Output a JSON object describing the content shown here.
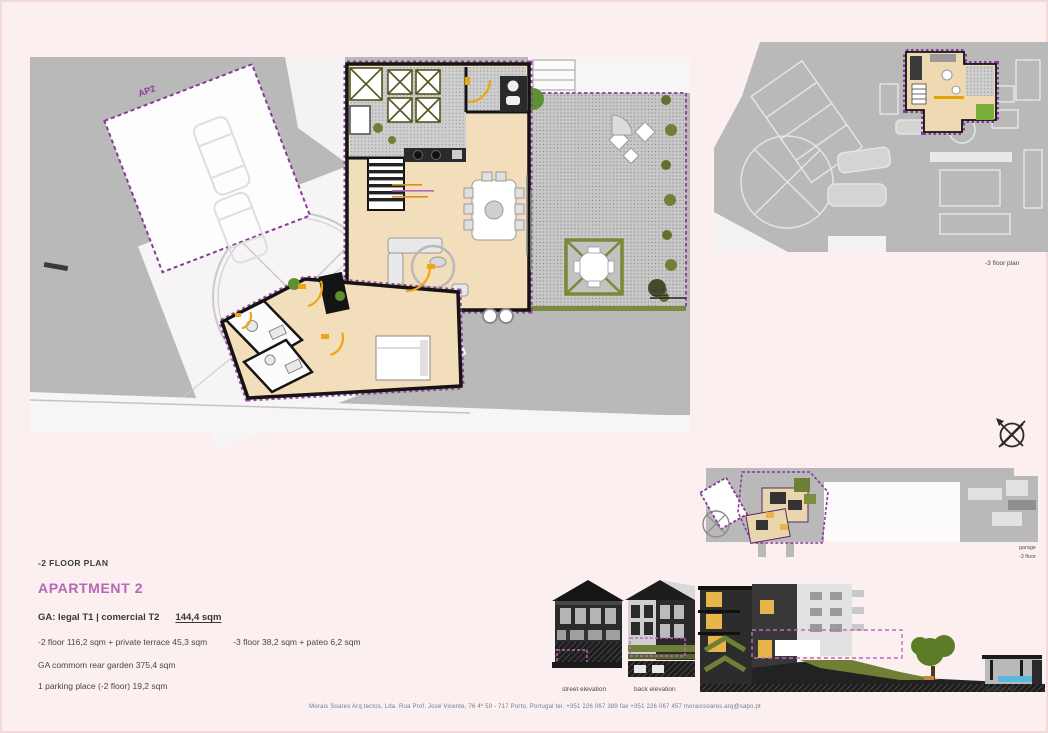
{
  "sheet": {
    "floor_plan_title": "-2 FLOOR PLAN",
    "apartment_title": "APARTMENT 2",
    "ga_line": {
      "label": "GA: legal T1   |  comercial T2",
      "area": "144,4 sqm"
    },
    "floors_line": {
      "minus2": "-2 floor   116,2 sqm  +  private terrace 45,3 sqm",
      "minus3": "-3 floor   38,2 sqm  +  pateo 6,2 sqm"
    },
    "garden_line": "GA commom rear garden 375,4 sqm",
    "parking_line": "1 parking place (-2 floor) 19,2 sqm",
    "footer": "Morais Soares Arq.tectos, Lda.  Rua Prof. José Vicente, 76  4º 50 - 717 Porto, Portugal   tel. +351 226 067 389   fax +351 226 067 457    moraissoares.arq@sapo.pt"
  },
  "plans": {
    "main": {
      "unit_label": "AP2",
      "section_marker": "sec AA"
    },
    "top_right": {
      "caption": "-3 floor plan"
    },
    "strip": {
      "caption_line1": "garage",
      "caption_line2": "-3 floor"
    }
  },
  "elevations": {
    "captions": [
      "street elevation",
      "back elevation",
      "section AA"
    ]
  },
  "icons": {
    "north_arrow": "crossed-circle-compass"
  },
  "colors": {
    "page_bg": "#fbeff0",
    "context_gray": "#b9b9b9",
    "floor_beige": "#f2deba",
    "wall_black": "#141414",
    "accent_purple": "#8b3a9b",
    "apartment_title_purple": "#b767bb",
    "door_orange": "#eda713",
    "plant_green": "#5f8f35",
    "olive": "#6f7f35",
    "water_blue": "#58b8dc",
    "footer_blue_gray": "#6b7f96"
  }
}
